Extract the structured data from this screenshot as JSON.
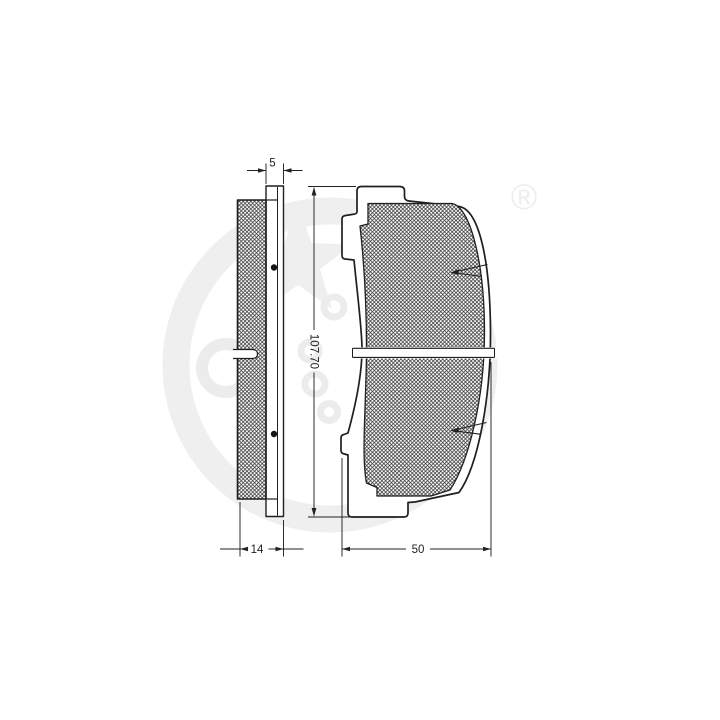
{
  "drawing": {
    "type": "brake-pad technical drawing (parts catalog)",
    "colors": {
      "line": "#1f1f1f",
      "background": "#ffffff",
      "watermark": "#ededed",
      "registered_mark_color": "#e9e9e9"
    },
    "dimensions": {
      "plate_thickness": "5",
      "pad_height": "107.70",
      "total_thickness": "14",
      "pad_width": "50"
    },
    "watermark": {
      "registered_mark": "®"
    }
  }
}
